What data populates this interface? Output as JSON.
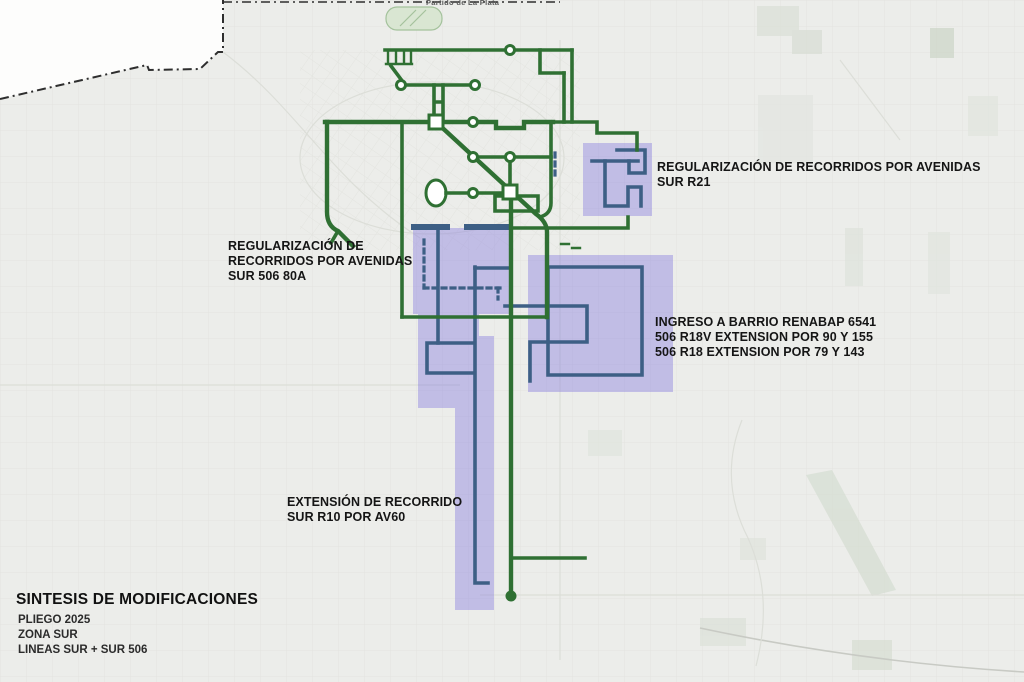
{
  "map": {
    "region_label": "Partido de La Plata",
    "colors": {
      "map_bg": "#ecedea",
      "route_green": "#2f7033",
      "modification_blue": "#3d5f85",
      "highlight_purple": "#8276df"
    }
  },
  "annotations": {
    "r21": {
      "line1": "REGULARIZACIÓN DE RECORRIDOS POR AVENIDAS",
      "line2": "SUR R21"
    },
    "sur506": {
      "line1": "REGULARIZACIÓN DE",
      "line2": "RECORRIDOS POR AVENIDAS",
      "line3": "SUR 506 80A"
    },
    "renabap": {
      "line1": "INGRESO A BARRIO RENABAP 6541",
      "line2": "506 R18V EXTENSION POR 90 Y 155",
      "line3": "506 R18 EXTENSION POR 79 Y 143"
    },
    "r10": {
      "line1": "EXTENSIÓN DE RECORRIDO",
      "line2": "SUR R10 POR AV60"
    }
  },
  "legend": {
    "title": "SINTESIS DE MODIFICACIONES",
    "line1": "PLIEGO 2025",
    "line2": "ZONA SUR",
    "line3": "LINEAS SUR + SUR 506"
  }
}
